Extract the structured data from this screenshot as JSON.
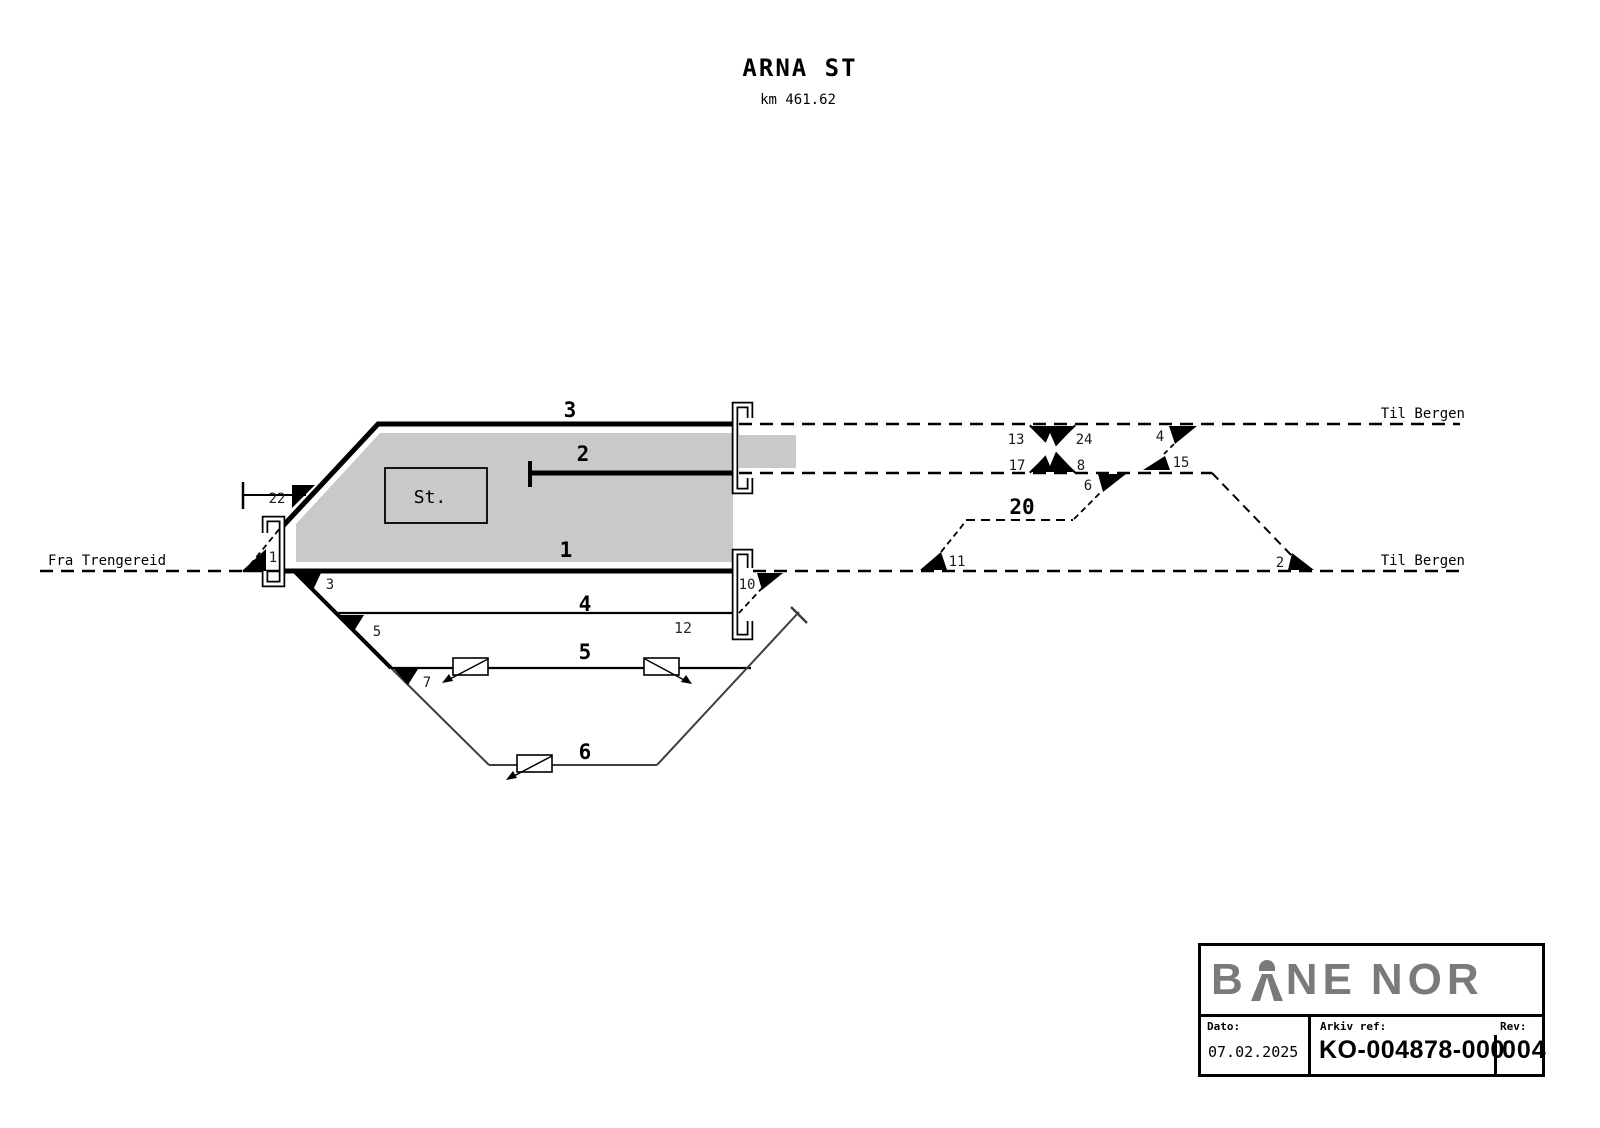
{
  "header": {
    "station": "ARNA ST",
    "km": "km 461.62"
  },
  "directions": {
    "from_left": "Fra Trengereid",
    "to_top_right": "Til Bergen",
    "to_bottom_right": "Til Bergen"
  },
  "station": {
    "building": "St."
  },
  "track_labels": {
    "t1": "1",
    "t2": "2",
    "t3": "3",
    "t4": "4",
    "t5": "5",
    "t6": "6",
    "t12": "12",
    "t20": "20"
  },
  "switch_labels": {
    "s1": "1",
    "s2": "2",
    "s3": "3",
    "s4": "4",
    "s5": "5",
    "s6": "6",
    "s7": "7",
    "s8": "8",
    "s10": "10",
    "s11": "11",
    "s13": "13",
    "s15": "15",
    "s17": "17",
    "s22": "22",
    "s24": "24"
  },
  "title_block": {
    "brand_b": "B",
    "brand_ne": "NE",
    "brand_nor": "NOR",
    "date_label": "Dato:",
    "date_value": "07.02.2025",
    "archive_label": "Arkiv ref:",
    "archive_value": "KO-004878-000",
    "rev_label": "Rev:",
    "rev_value": "004"
  },
  "colors": {
    "platform": "#c9c9c9",
    "track": "#000000",
    "yard": "#3d3d3d",
    "logo": "#7a7a7a"
  }
}
